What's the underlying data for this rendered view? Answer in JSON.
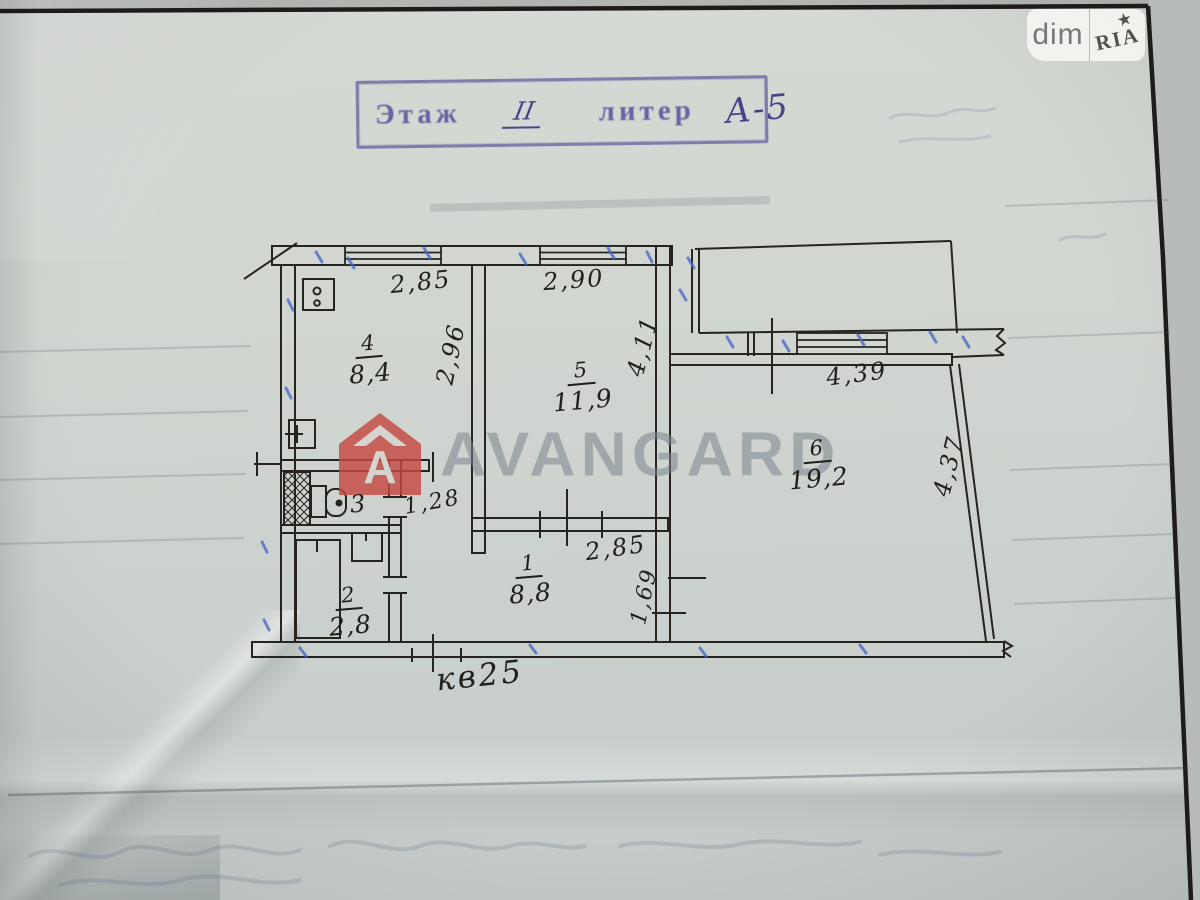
{
  "badge": {
    "dim": "dim",
    "ria": "RIA"
  },
  "icons": {
    "star": "★"
  },
  "stamp": {
    "floor_label": "Этаж",
    "floor_value": "II",
    "liter_label": "литер",
    "liter_value": "А-5"
  },
  "watermark": {
    "brand": "AVANGARD",
    "logo_letter": "A"
  },
  "plan": {
    "apartment_label": "кв25",
    "rooms": {
      "kitchen": {
        "number": "4",
        "area": "8,4"
      },
      "room5": {
        "number": "5",
        "area": "11,9"
      },
      "room6": {
        "number": "6",
        "area": "19,2"
      },
      "wc": {
        "number": "3"
      },
      "bath": {
        "number": "2",
        "area": "2,8"
      },
      "hall": {
        "number": "1",
        "area": "8,8"
      }
    },
    "dims": {
      "d285_top": "2,85",
      "d290": "2,90",
      "d296": "2,96",
      "d411": "4,11",
      "d439": "4,39",
      "d437": "4,37",
      "d128": "1,28",
      "d285_hall": "2,85",
      "d169": "1,69"
    }
  },
  "colors": {
    "paper": "#cfd4cf",
    "ink": "#26241f",
    "stamp_ink": "#4a4296",
    "watermark_text": "#7d8892",
    "watermark_red": "#c4483f",
    "blue_tick": "#4a6bc6"
  }
}
